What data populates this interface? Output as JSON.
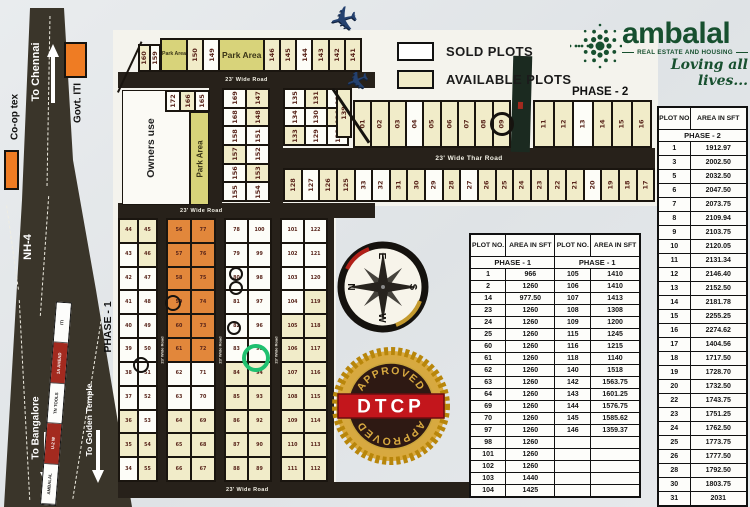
{
  "branding": {
    "name": "ambalal",
    "tagline": "REAL ESTATE AND HOUSING",
    "slogan": "Loving all lives...",
    "accent_green": "#17502f"
  },
  "legend": {
    "sold_label": "SOLD PLOTS",
    "available_label": "AVAILABLE PLOTS",
    "sold_color": "#ffffff",
    "available_color": "#f1ecc9"
  },
  "labels": {
    "phase1": "PHASE - 1",
    "phase2": "PHASE - 2",
    "owners_use": "Owners use",
    "park_area": "Park Area",
    "wide_road": "23' Wide Road",
    "wide_thar_road": "23' Wide Thar Road",
    "nh4": "NH-4",
    "to_chennai": "To Chennai",
    "to_bangalore": "To Bangalore",
    "to_golden_temple": "To Golden Temple",
    "coop_tex": "Co-op tex",
    "govt_iti": "Govt. ITI"
  },
  "median_signs": [
    "ITI",
    "1A AHEAD",
    "TN TOOLS",
    "U-2 W",
    "AMBALAL"
  ],
  "icons": {
    "airplane": "✈"
  },
  "compass": {
    "n": "N",
    "e": "E",
    "s": "S",
    "w": "W"
  },
  "seal": {
    "band": "DTCP",
    "arc_top": "APPROVED",
    "arc_bottom": "APPROVED"
  },
  "phase2_table": {
    "col_headers": [
      "PLOT NO",
      "AREA IN SFT"
    ],
    "section": "PHASE - 2",
    "rows": [
      [
        "1",
        "1912.97"
      ],
      [
        "3",
        "2002.50"
      ],
      [
        "5",
        "2032.50"
      ],
      [
        "6",
        "2047.50"
      ],
      [
        "7",
        "2073.75"
      ],
      [
        "8",
        "2109.94"
      ],
      [
        "9",
        "2103.75"
      ],
      [
        "10",
        "2120.05"
      ],
      [
        "11",
        "2131.34"
      ],
      [
        "12",
        "2146.40"
      ],
      [
        "13",
        "2152.50"
      ],
      [
        "14",
        "2181.78"
      ],
      [
        "15",
        "2255.25"
      ],
      [
        "16",
        "2274.62"
      ],
      [
        "17",
        "1404.56"
      ],
      [
        "18",
        "1717.50"
      ],
      [
        "19",
        "1728.70"
      ],
      [
        "20",
        "1732.50"
      ],
      [
        "22",
        "1743.75"
      ],
      [
        "23",
        "1751.25"
      ],
      [
        "24",
        "1762.50"
      ],
      [
        "25",
        "1773.75"
      ],
      [
        "26",
        "1777.50"
      ],
      [
        "28",
        "1792.50"
      ],
      [
        "30",
        "1803.75"
      ],
      [
        "31",
        "2031"
      ]
    ]
  },
  "phase1_table": {
    "col_headers": [
      "PLOT NO.",
      "AREA IN SFT",
      "PLOT NO.",
      "AREA IN SFT"
    ],
    "section_left": "PHASE - 1",
    "section_right": "PHASE - 1",
    "rows": [
      [
        "1",
        "966",
        "105",
        "1410"
      ],
      [
        "2",
        "1260",
        "106",
        "1410"
      ],
      [
        "14",
        "977.50",
        "107",
        "1413"
      ],
      [
        "23",
        "1260",
        "108",
        "1308"
      ],
      [
        "24",
        "1260",
        "109",
        "1200"
      ],
      [
        "25",
        "1260",
        "115",
        "1245"
      ],
      [
        "60",
        "1260",
        "116",
        "1215"
      ],
      [
        "61",
        "1260",
        "118",
        "1140"
      ],
      [
        "62",
        "1260",
        "140",
        "1518"
      ],
      [
        "63",
        "1260",
        "142",
        "1563.75"
      ],
      [
        "64",
        "1260",
        "143",
        "1601.25"
      ],
      [
        "69",
        "1260",
        "144",
        "1576.75"
      ],
      [
        "70",
        "1260",
        "145",
        "1585.62"
      ],
      [
        "97",
        "1260",
        "146",
        "1359.37"
      ],
      [
        "98",
        "1260",
        "",
        ""
      ],
      [
        "101",
        "1260",
        "",
        ""
      ],
      [
        "102",
        "1260",
        "",
        ""
      ],
      [
        "103",
        "1440",
        "",
        ""
      ],
      [
        "104",
        "1425",
        "",
        ""
      ]
    ]
  },
  "map": {
    "fill_colors": {
      "s": "#fdfdf8",
      "a": "#f1ecc9",
      "o": "#e2873b",
      "p": "#d8d37a"
    },
    "blocks": [
      {
        "name": "top-edge",
        "x": 138,
        "y": 44,
        "w": 23,
        "h": 28,
        "cols": 2,
        "rows": 1,
        "rot": true,
        "cells": [
          "160|a",
          "159|s"
        ]
      },
      {
        "name": "top-row",
        "x": 160,
        "y": 38,
        "w": 202,
        "h": 34,
        "cols": 10,
        "rows": 1,
        "rot": true,
        "cells": [
          {
            "n": "Park Area",
            "fill": "p",
            "f": 1.7,
            "lab": 1,
            "fs": 5.2
          },
          "150|a",
          "149|s",
          {
            "n": "Park Area",
            "fill": "p",
            "f": 3,
            "lab": 1,
            "fs": 8.5
          },
          "146|a",
          "145|a",
          "144|s",
          "143|a",
          "142|a",
          "141|a"
        ]
      },
      {
        "name": "block-165",
        "x": 165,
        "y": 90,
        "w": 45,
        "h": 22,
        "cols": 3,
        "rows": 1,
        "rot": true,
        "cells": [
          "172|s",
          "166|a",
          "165|s"
        ]
      },
      {
        "name": "block-150s",
        "x": 222,
        "y": 88,
        "w": 48,
        "h": 114,
        "cols": 2,
        "rows": 6,
        "rot": true,
        "cells": [
          "169|s",
          "147|a",
          "168|s",
          "148|a",
          "158|s",
          "151|s",
          "157|a",
          "152|s",
          "156|s",
          "153|a",
          "155|s",
          "154|s"
        ]
      },
      {
        "name": "block-130s",
        "x": 283,
        "y": 88,
        "w": 66,
        "h": 58,
        "cols": 3,
        "rows": 3,
        "rot": true,
        "cells": [
          "135|s",
          "131|a",
          "137|s",
          "134|s",
          "130|s",
          "136|a",
          "133|a",
          "129|s",
          "138|s"
        ]
      },
      {
        "name": "plot-139",
        "x": 336,
        "y": 88,
        "w": 16,
        "h": 50,
        "cols": 1,
        "rows": 1,
        "rot": true,
        "cells": [
          "139|a"
        ]
      },
      {
        "name": "phase2-upper-a",
        "x": 353,
        "y": 100,
        "w": 158,
        "h": 48,
        "cols": 9,
        "rows": 1,
        "rot": true,
        "cells": [
          "01|a",
          "02|a",
          "03|a",
          "04|s",
          "05|a",
          "06|a",
          "07|a",
          "08|a",
          "09|a"
        ]
      },
      {
        "name": "phase2-upper-b",
        "x": 533,
        "y": 100,
        "w": 119,
        "h": 48,
        "cols": 6,
        "rows": 1,
        "rot": true,
        "cells": [
          "11|a",
          "12|a",
          "13|s",
          "14|a",
          "15|a",
          "16|a"
        ]
      },
      {
        "name": "phase2-lower",
        "x": 283,
        "y": 168,
        "w": 372,
        "h": 34,
        "cols": 21,
        "rows": 1,
        "rot": true,
        "cells": [
          "128|a",
          "127|s",
          "126|a",
          "125|a",
          "33|s",
          "32|s",
          "31|a",
          "30|a",
          "29|s",
          "28|a",
          "27|s",
          "26|a",
          "25|a",
          "24|a",
          "23|a",
          "22|a",
          "21|a",
          "20|s",
          "19|a",
          "18|a",
          "17|a"
        ]
      },
      {
        "name": "phase1-col1",
        "x": 118,
        "y": 218,
        "w": 40,
        "h": 264,
        "cols": 2,
        "rows": 11,
        "small": true,
        "cells": [
          "44|a",
          "45|a",
          "43|s",
          "46|a",
          "42|s",
          "47|s",
          "41|s",
          "48|s",
          "40|s",
          "49|s",
          "39|s",
          "50|s",
          "38|s",
          "51|s",
          "37|s",
          "52|s",
          "36|a",
          "53|s",
          "35|a",
          "54|a",
          "34|s",
          "55|a"
        ]
      },
      {
        "name": "phase1-col2",
        "x": 166,
        "y": 218,
        "w": 50,
        "h": 264,
        "cols": 2,
        "rows": 11,
        "small": true,
        "cells": [
          "56|o",
          "77|o",
          "57|o",
          "76|o",
          "58|o",
          "75|o",
          "59|o",
          "74|o",
          "60|o",
          "73|o",
          "61|o",
          "72|o",
          "62|s",
          "71|s",
          "63|s",
          "70|s",
          "64|a",
          "69|a",
          "65|a",
          "68|a",
          "66|a",
          "67|a"
        ]
      },
      {
        "name": "phase1-col3",
        "x": 224,
        "y": 218,
        "w": 48,
        "h": 264,
        "cols": 2,
        "rows": 11,
        "small": true,
        "cells": [
          "78|s",
          "100|s",
          "79|s",
          "99|s",
          "80|s",
          "98|s",
          "81|s",
          "97|s",
          "82|s",
          "96|s",
          "83|s",
          "95|s",
          "84|a",
          "94|a",
          "85|a",
          "93|a",
          "86|a",
          "92|a",
          "87|a",
          "90|a",
          "88|a",
          "89|a"
        ]
      },
      {
        "name": "phase1-col4",
        "x": 280,
        "y": 218,
        "w": 48,
        "h": 264,
        "cols": 2,
        "rows": 11,
        "small": true,
        "cells": [
          "101|s",
          "122|s",
          "102|s",
          "121|s",
          "103|s",
          "120|s",
          "104|s",
          "119|a",
          "105|a",
          "118|a",
          "106|a",
          "117|a",
          "107|a",
          "116|a",
          "108|a",
          "115|a",
          "109|a",
          "114|a",
          "110|a",
          "113|a",
          "111|a",
          "112|a"
        ]
      }
    ],
    "marks": [
      {
        "t": "c",
        "x": 502,
        "y": 124,
        "r": 12,
        "c": "#16130f",
        "sw": 3.5
      },
      {
        "t": "c",
        "x": 173,
        "y": 303,
        "r": 8,
        "c": "#16130f",
        "sw": 2.5
      },
      {
        "t": "c",
        "x": 236,
        "y": 274,
        "r": 7,
        "c": "#16130f",
        "sw": 2.5
      },
      {
        "t": "c",
        "x": 236,
        "y": 288,
        "r": 7,
        "c": "#16130f",
        "sw": 2.5
      },
      {
        "t": "c",
        "x": 234,
        "y": 328,
        "r": 7,
        "c": "#16130f",
        "sw": 2.5
      },
      {
        "t": "c",
        "x": 141,
        "y": 365,
        "r": 8,
        "c": "#16130f",
        "sw": 2.5
      },
      {
        "t": "c",
        "x": 256,
        "y": 358,
        "r": 14,
        "c": "#1fc06f",
        "sw": 4.5
      },
      {
        "t": "l",
        "x": 334,
        "y": 88,
        "len": 65,
        "ang": 56,
        "sw": 3
      }
    ]
  }
}
